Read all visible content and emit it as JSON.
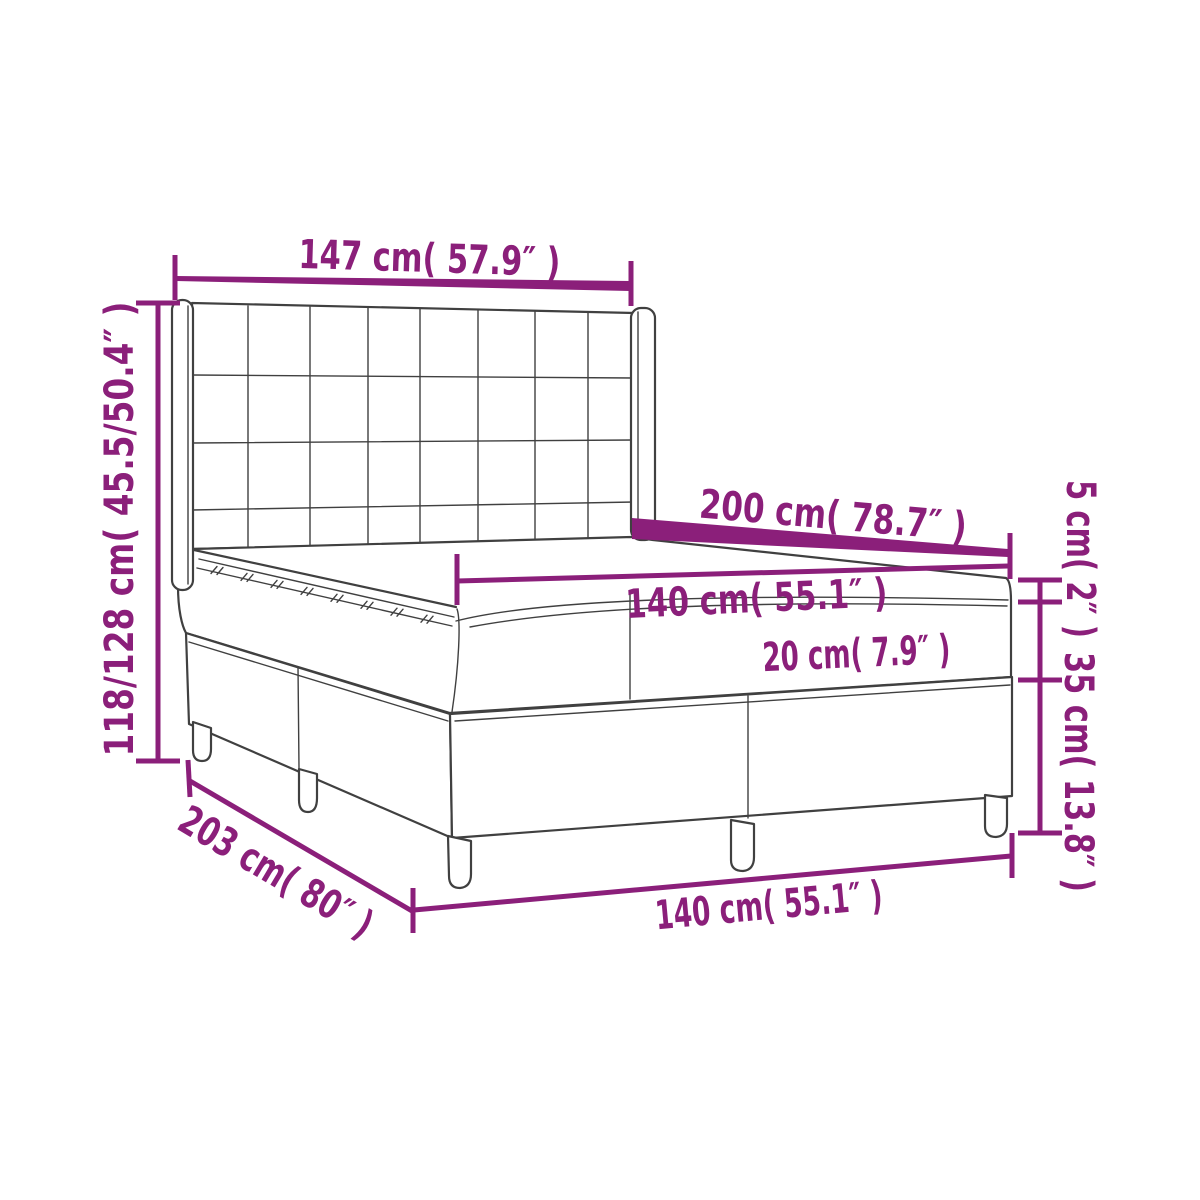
{
  "figure": {
    "kind": "product-dimension-diagram",
    "subject": "box spring bed with tufted wing headboard, mattress and topper",
    "accent_color": "#8b1f7a",
    "line_color": "#404040",
    "background_color": "#ffffff"
  },
  "dimensions": {
    "headboard_width": "147 cm( 57.9″ )",
    "overall_height": "118/128 cm( 45.5/50.4″ )",
    "bed_length_top": "200 cm( 78.7″ )",
    "mattress_width_top": "140 cm( 55.1″ )",
    "mattress_height": "20 cm( 7.9″ )",
    "topper_height": "5 cm( 2″ )",
    "base_height": "35 cm( 13.8″ )",
    "overall_length_bottom": "203 cm( 80″ )",
    "base_width_bottom": "140 cm( 55.1″ )"
  }
}
